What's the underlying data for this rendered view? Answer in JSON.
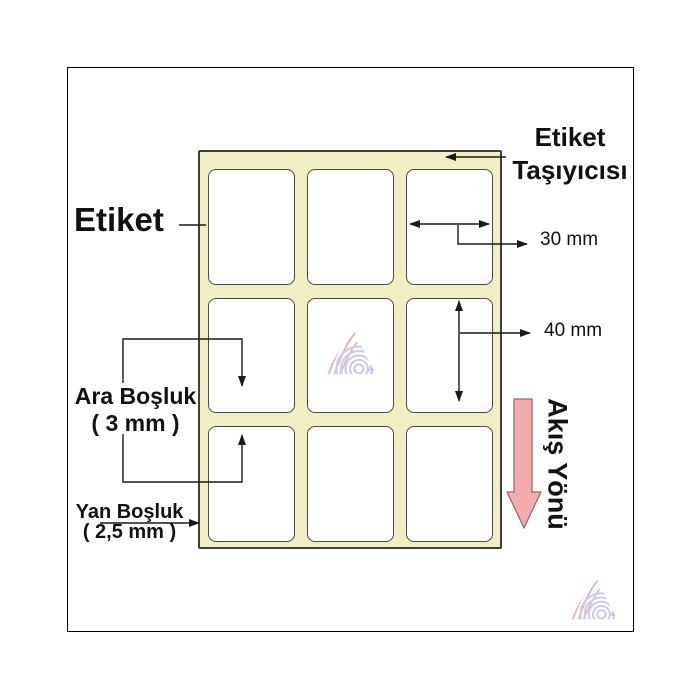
{
  "diagram": {
    "label_callout": "Etiket",
    "carrier_callout_line1": "Etiket",
    "carrier_callout_line2": "Taşıyıcısı",
    "width_dimension": "30 mm",
    "height_dimension": "40 mm",
    "gap_callout_line1": "Ara Boşluk",
    "gap_callout_line2": "( 3 mm )",
    "side_margin_callout_line1": "Yan Boşluk",
    "side_margin_callout_line2": "( 2,5 mm )",
    "flow_direction_label": "Akış Yönü",
    "grid_rows": 3,
    "grid_cols": 3
  },
  "colors": {
    "carrier_fill": "#f2eec3",
    "carrier_border": "#3f3f3f",
    "label_fill": "#ffffff",
    "label_border": "#4a4a4a",
    "annotation_line": "#1a1a1a",
    "text": "#111111",
    "flow_arrow_fill": "#f3abab",
    "flow_arrow_border": "#9a6464",
    "frame_border": "#000000",
    "watermark_red": "#d27f7f",
    "watermark_blue": "#a0a4d8",
    "watermark_purple": "#b5a8cf"
  },
  "icons": {
    "flow_arrow": "down-arrow",
    "watermark": "wavy-triangle-logo"
  }
}
